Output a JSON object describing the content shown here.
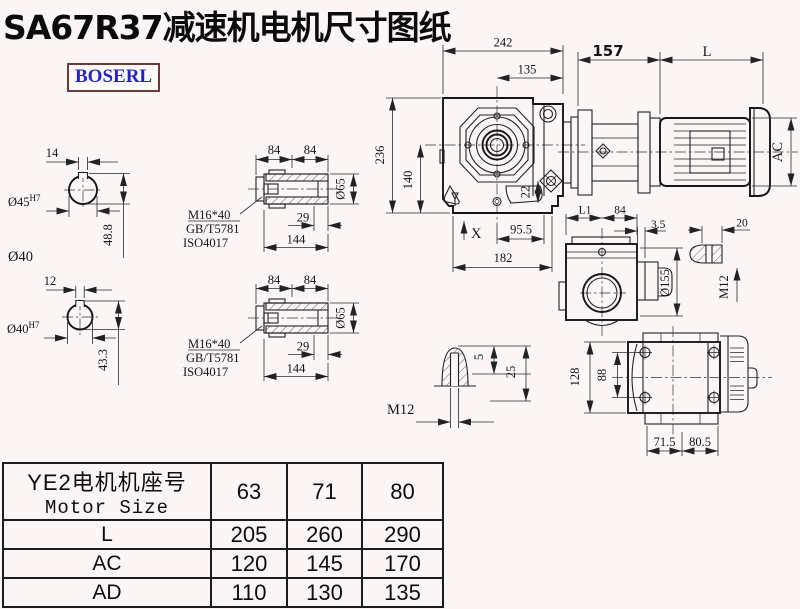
{
  "title": "SA67R37减速机电机尺寸图纸",
  "logo": "BOSERL",
  "hub1": {
    "keyway": "14",
    "bore": "Ø45",
    "tol": "H7",
    "height": "48.8",
    "shaft_label": "Ø40"
  },
  "hub2": {
    "keyway": "12",
    "bore": "Ø40",
    "tol": "H7",
    "height": "43.3"
  },
  "sleeve": {
    "seg_a": "84",
    "seg_b": "84",
    "thread": "M16*40",
    "std1": "GB/T5781",
    "std2": "ISO4017",
    "depth": "29",
    "length": "144",
    "dia": "Ø65"
  },
  "front": {
    "width": "242",
    "width_upper": "135",
    "height": "236",
    "center_height": "140",
    "offset": "22",
    "marker": "X",
    "base_a": "95.5",
    "base_b": "182"
  },
  "motor": {
    "adapter": "157",
    "length": "L",
    "dia": "AC"
  },
  "side": {
    "l1": "L1",
    "w": "84",
    "step": "3.5",
    "flange": "Ø155",
    "tab": "20",
    "thread": "M12"
  },
  "stud": {
    "tip": "5",
    "length": "25",
    "thread": "M12"
  },
  "bottom": {
    "height": "128",
    "bolt_span": "88",
    "a": "71.5",
    "b": "80.5"
  },
  "table": {
    "header_cn": "YE2电机机座号",
    "header_en": "Motor Size",
    "sizes": [
      "63",
      "71",
      "80"
    ],
    "rows": [
      {
        "label": "L",
        "values": [
          "205",
          "260",
          "290"
        ]
      },
      {
        "label": "AC",
        "values": [
          "120",
          "145",
          "170"
        ]
      },
      {
        "label": "AD",
        "values": [
          "110",
          "130",
          "135"
        ]
      }
    ]
  }
}
